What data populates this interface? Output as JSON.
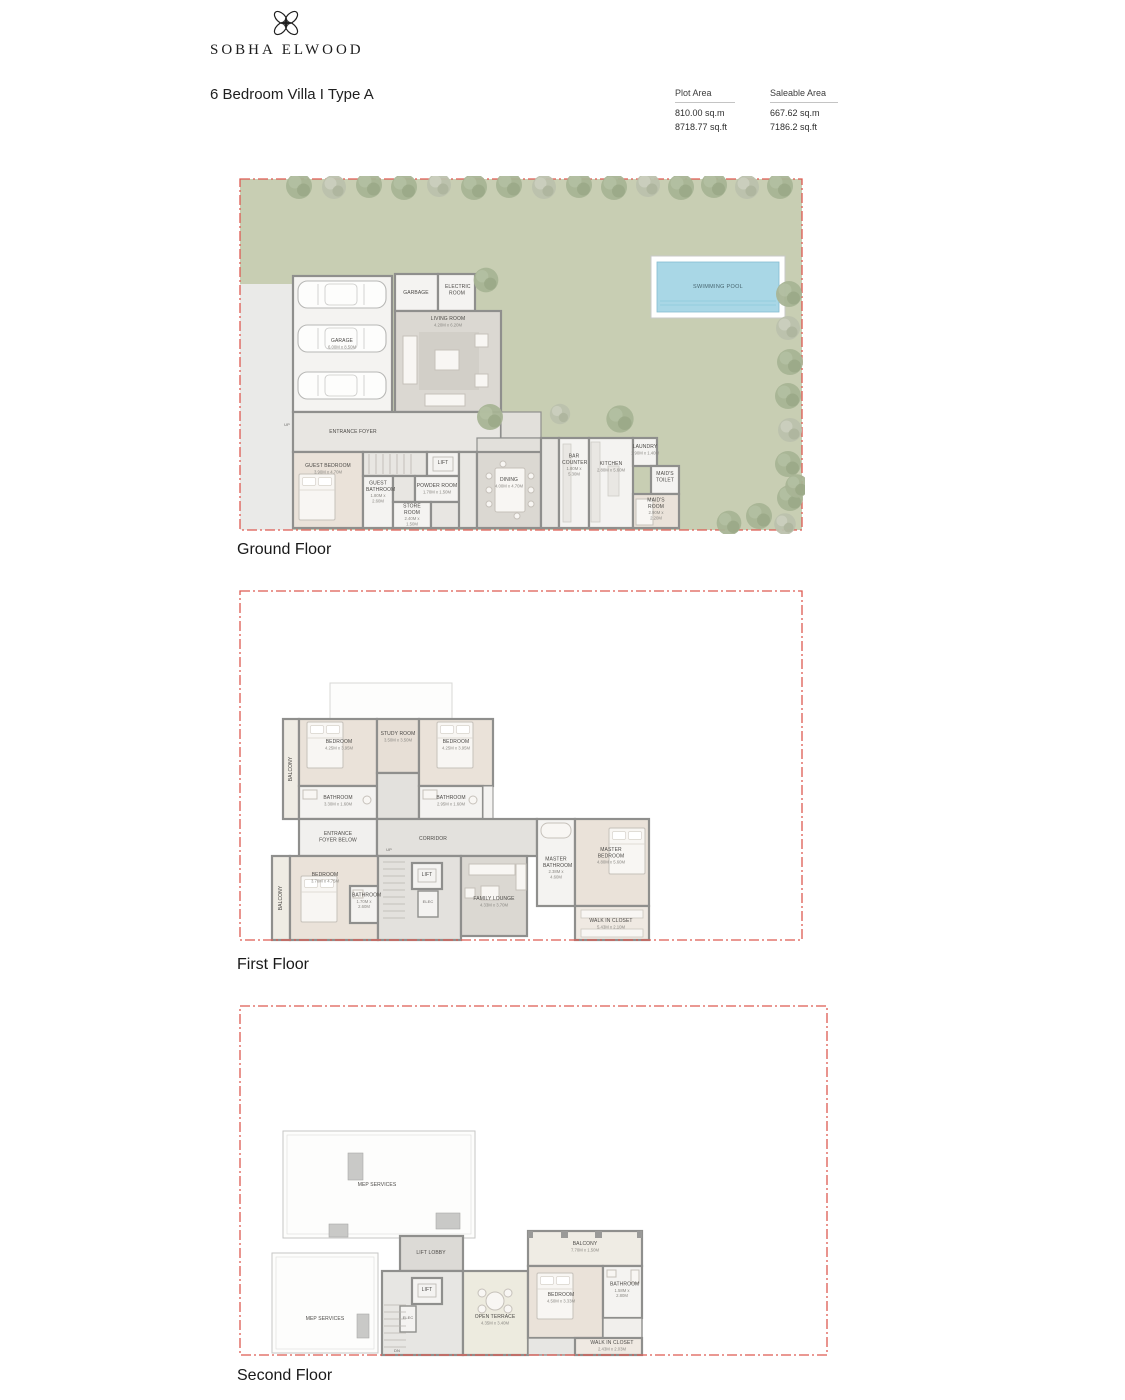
{
  "header": {
    "brand": "SOBHA ELWOOD",
    "title": "6 Bedroom Villa  I  Type A",
    "areas": [
      {
        "label": "Plot Area",
        "line1": "810.00 sq.m",
        "line2": "8718.77 sq.ft"
      },
      {
        "label": "Saleable Area",
        "line1": "667.62 sq.m",
        "line2": "7186.2 sq.ft"
      }
    ]
  },
  "colors": {
    "boundary_red": "#dd5a52",
    "lawn_green": "#c8ceb3",
    "pool_blue": "#a9d7e6",
    "bedroom_floor": "#eae2d9",
    "wall_gray": "#8f8f8d"
  },
  "floors": [
    {
      "name": "Ground Floor",
      "rooms": [
        {
          "label": "GARAGE",
          "dim": "6.00M x 8.50M"
        },
        {
          "label": "GARBAGE"
        },
        {
          "label": "ELECTRIC ROOM"
        },
        {
          "label": "LIVING ROOM",
          "dim": "4.20M x 6.20M"
        },
        {
          "label": "ENTRANCE FOYER"
        },
        {
          "label": "UP"
        },
        {
          "label": "GUEST BEDROOM",
          "dim": "3.90M x 4.70M"
        },
        {
          "label": "GUEST BATHROOM",
          "dim": "1.80M x 2.60M"
        },
        {
          "label": "STORE ROOM",
          "dim": "2.40M x 1.50M"
        },
        {
          "label": "POWDER ROOM",
          "dim": "1.70M x 1.50M"
        },
        {
          "label": "LIFT"
        },
        {
          "label": "DINING",
          "dim": "4.00M x 4.70M"
        },
        {
          "label": "BAR COUNTER",
          "dim": "1.80M x 5.30M"
        },
        {
          "label": "KITCHEN",
          "dim": "2.80M x 5.60M"
        },
        {
          "label": "LAUNDRY",
          "dim": "1.90M x 1.40M"
        },
        {
          "label": "MAID'S TOILET"
        },
        {
          "label": "MAID'S ROOM",
          "dim": "2.90M x 2.20M"
        },
        {
          "label": "SWIMMING POOL"
        }
      ]
    },
    {
      "name": "First Floor",
      "rooms": [
        {
          "label": "BALCONY"
        },
        {
          "label": "BEDROOM",
          "dim": "4.25M x 3.95M"
        },
        {
          "label": "BATHROOM",
          "dim": "3.30M x 1.60M"
        },
        {
          "label": "STUDY ROOM",
          "dim": "3.50M x 3.50M"
        },
        {
          "label": "BEDROOM",
          "dim": "4.25M x 3.95M"
        },
        {
          "label": "BATHROOM",
          "dim": "2.95M x 1.60M"
        },
        {
          "label": "ENTRANCE FOYER BELOW"
        },
        {
          "label": "CORRIDOR"
        },
        {
          "label": "UP"
        },
        {
          "label": "BALCONY"
        },
        {
          "label": "BEDROOM",
          "dim": "3.70M x 4.75M"
        },
        {
          "label": "BATHROOM",
          "dim": "1.70M x 2.60M"
        },
        {
          "label": "LIFT"
        },
        {
          "label": "ELEC"
        },
        {
          "label": "FAMILY LOUNGE",
          "dim": "4.33M x 3.70M"
        },
        {
          "label": "MASTER BATHROOM",
          "dim": "2.38M x 4.60M"
        },
        {
          "label": "MASTER BEDROOM",
          "dim": "4.80M x 5.60M"
        },
        {
          "label": "WALK IN CLOSET",
          "dim": "5.43M x 2.10M"
        }
      ]
    },
    {
      "name": "Second Floor",
      "rooms": [
        {
          "label": "MEP SERVICES"
        },
        {
          "label": "MEP SERVICES"
        },
        {
          "label": "LIFT LOBBY"
        },
        {
          "label": "LIFT"
        },
        {
          "label": "ELEC"
        },
        {
          "label": "DN"
        },
        {
          "label": "OPEN TERRACE",
          "dim": "4.35M x 3.40M"
        },
        {
          "label": "BALCONY",
          "dim": "7.70M x 1.50M"
        },
        {
          "label": "BEDROOM",
          "dim": "4.50M x 3.33M"
        },
        {
          "label": "BATHROOM",
          "dim": "1.58M x 2.80M"
        },
        {
          "label": "WALK IN CLOSET",
          "dim": "2.43M x 2.03M"
        }
      ]
    }
  ]
}
